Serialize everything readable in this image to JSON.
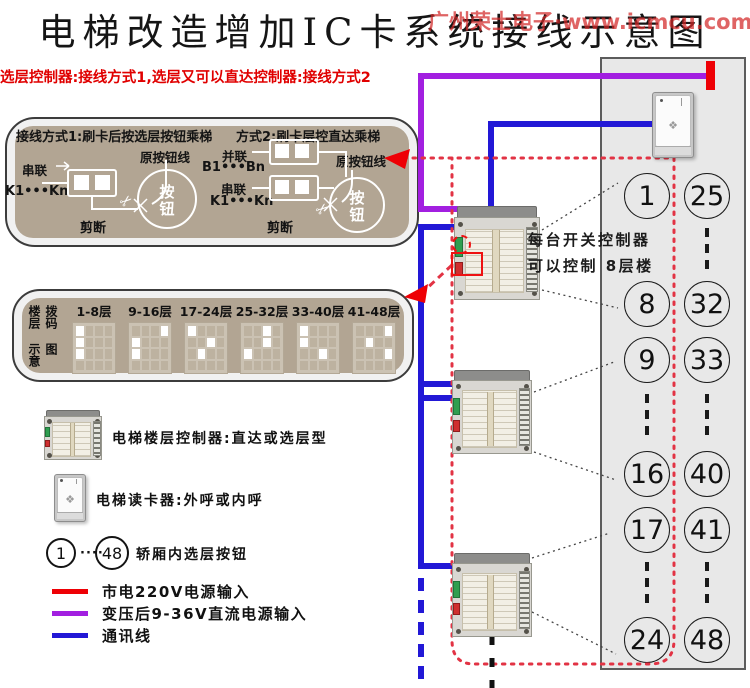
{
  "title": "电梯改造增加IC卡系统接线示意图",
  "watermark": "广州荣士电子·www.icmcu.com",
  "subtitle": "选层控制器:接线方式1,选层又可以直达控制器:接线方式2",
  "wiring_box": {
    "method1": {
      "title": "接线方式1:刷卡后按选层按钮乘梯",
      "series": "串联",
      "series_range": "K1•••Kn",
      "original_line": "原按钮线",
      "button": "按钮",
      "cut": "剪断"
    },
    "method2": {
      "title": "方式2:刷卡层控直达乘梯",
      "parallel": "并联",
      "parallel_range": "B1•••Bn",
      "series": "串联",
      "series_range": "K1•••Kn",
      "original_line": "原按钮线",
      "button": "按钮",
      "cut": "剪断"
    }
  },
  "dip_box": {
    "side_label_1": "楼层拨码",
    "side_label_2": "示意图",
    "rows": 4,
    "cols": 4,
    "groups": [
      {
        "label": "1-8层",
        "on": [
          [
            0,
            0
          ],
          [
            1,
            0
          ],
          [
            2,
            0
          ]
        ]
      },
      {
        "label": "9-16层",
        "on": [
          [
            0,
            3
          ],
          [
            1,
            0
          ],
          [
            2,
            0
          ]
        ]
      },
      {
        "label": "17-24层",
        "on": [
          [
            0,
            0
          ],
          [
            1,
            2
          ],
          [
            2,
            1
          ]
        ]
      },
      {
        "label": "25-32层",
        "on": [
          [
            0,
            2
          ],
          [
            1,
            2
          ],
          [
            2,
            0
          ]
        ]
      },
      {
        "label": "33-40层",
        "on": [
          [
            0,
            0
          ],
          [
            1,
            0
          ],
          [
            2,
            2
          ]
        ]
      },
      {
        "label": "41-48层",
        "on": [
          [
            0,
            3
          ],
          [
            1,
            1
          ],
          [
            2,
            3
          ]
        ]
      }
    ]
  },
  "controller_note": {
    "line1": "每台开关控制器",
    "line2": "可以控制 8层楼"
  },
  "legend": {
    "controller_label": "电梯楼层控制器:直达或选层型",
    "reader_label": "电梯读卡器:外呼或内呼",
    "button_first": "1",
    "button_last": "48",
    "buttons_label": "轿厢内选层按钮",
    "dots": "····"
  },
  "line_legend": [
    {
      "color": "#ee0005",
      "label": "市电220V电源输入"
    },
    {
      "color": "#a21fe0",
      "label": "变压后9-36V直流电源输入"
    },
    {
      "color": "#2218d6",
      "label": "通讯线"
    }
  ],
  "panel": {
    "left_column": [
      "1",
      "8",
      "9",
      "16",
      "17",
      "24"
    ],
    "right_column": [
      "25",
      "32",
      "33",
      "40",
      "41",
      "48"
    ]
  },
  "colors": {
    "power220": "#ee0005",
    "dc": "#a21fe0",
    "comm": "#2218d6",
    "dotted_red": "#e23344",
    "link_black": "#444444",
    "panel_bg": "#e8e8e8",
    "box_inner": "#b2a593",
    "wire_white": "#ffffff"
  }
}
